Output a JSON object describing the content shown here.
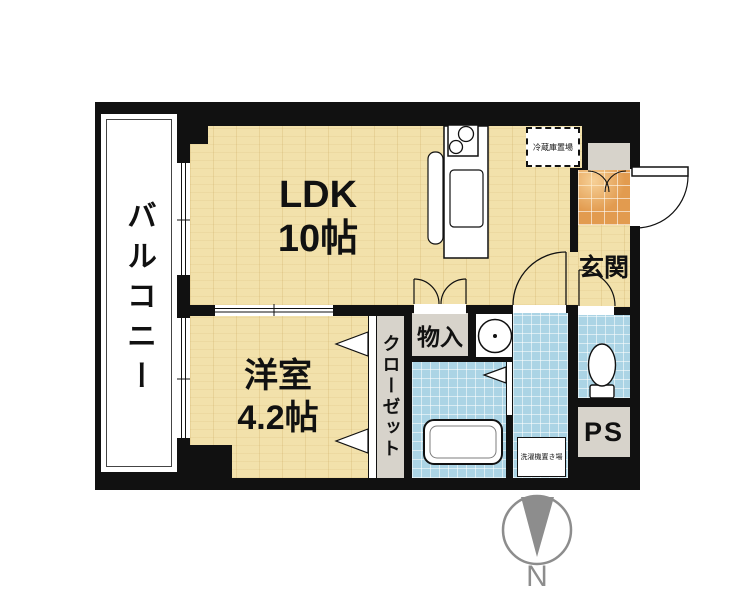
{
  "rooms": {
    "balcony": {
      "label": "バルコニー"
    },
    "ldk": {
      "line1": "LDK",
      "line2": "10帖"
    },
    "western_room": {
      "line1": "洋室",
      "line2": "4.2帖"
    },
    "closet": {
      "label": "クローゼット"
    },
    "storage": {
      "label": "物入"
    },
    "entrance": {
      "label": "玄関"
    },
    "pipe_space": {
      "label": "PS"
    },
    "refrigerator_space": {
      "label": "冷蔵庫置場"
    },
    "washing_machine_space": {
      "label": "洗濯機置き場"
    }
  },
  "compass": {
    "north_label": "N"
  },
  "colors": {
    "wall": "#111111",
    "wood_floor": "#f2e1ab",
    "wet_area_tile": "#abd4e5",
    "entrance_tile": "#e29b4f",
    "utility_gray": "#d7d3cb",
    "compass_gray": "#8d8d8d"
  }
}
